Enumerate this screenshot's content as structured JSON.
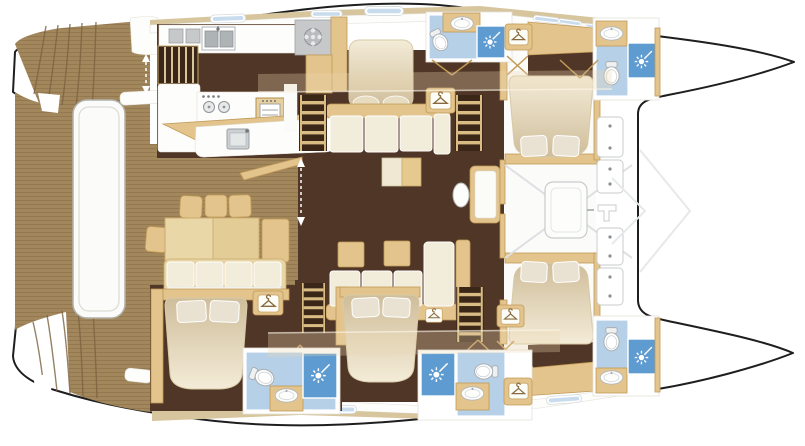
{
  "meta": {
    "label": "Catamaran yacht accommodation floor plan (top view)",
    "view": "overhead deck and cabin layout",
    "orientation": "bows pointing right, twin hulls, stern platform at left"
  },
  "colors": {
    "bg": "#ffffff",
    "line": "#1e1e1e",
    "wood": "#a3875c",
    "woodLine": "#7a6140",
    "deckTan": "#d7c59d",
    "wallTan": "#e2c48c",
    "wallEdge": "#c29a58",
    "floorDark": "#503626",
    "cream": "#f2ecda",
    "bedTop": "#f2e9d2",
    "bedBottom": "#cdb astonishing",
    "gray": "#c6c8ca",
    "bathFloor": "#b6d0e8",
    "bathShower": "#5e9bd0",
    "windowBlue": "#c8dcee"
  },
  "areas": {
    "aft_deck": {
      "label": "Aft cockpit teak deck with transom steps"
    },
    "swim_platform": {
      "label": "Hydraulic swim platform / tender lift"
    },
    "cockpit_dining": {
      "label": "Cockpit dining table with chairs and bench sofa"
    },
    "galley": {
      "label": "Galley with double sink, cooktop, oven and island"
    },
    "salon": {
      "label": "Salon lounge with L-shaped sofas and side tables"
    },
    "forward_cockpit": {
      "label": "Forward cockpit with bench and deck lockers"
    },
    "trampoline": {
      "label": "Foredeck trampoline area between bows"
    },
    "cabin_fwd_stb": {
      "label": "Forward starboard cabin with double berth"
    },
    "cabin_fwd_port": {
      "label": "Forward port cabin with double berth"
    },
    "cabin_aft_port": {
      "label": "Aft port cabin with double berth"
    },
    "cabin_mid_port": {
      "label": "Mid port cabin with double berth"
    },
    "bath_top_center": {
      "label": "En-suite bathroom: shower, WC, washbasin"
    },
    "bath_bow_stb": {
      "label": "Bow bathroom: shower, WC, washbasin"
    },
    "bath_aft_port": {
      "label": "Aft bathroom: shower, WC, washbasin"
    },
    "bath_mid": {
      "label": "Mid bathroom: shower, WC, washbasin"
    },
    "bath_bow_port": {
      "label": "Bow bathroom: shower, WC, washbasin"
    }
  },
  "fixtures": {
    "double_berths": 5,
    "shower_stalls": 5,
    "toilets": 5,
    "washbasins": 6,
    "wardrobes": 6,
    "companionway_ladders": 4,
    "deck_lockers": 4
  },
  "icons": [
    "shower-spray-icon",
    "clothes-hanger-icon",
    "toilet-icon",
    "washbasin-icon",
    "double-sink-icon",
    "stove-burner-icon",
    "oven-icon",
    "cooktop-icon",
    "walkway-arrow-icon",
    "window-hatch-icon"
  ]
}
